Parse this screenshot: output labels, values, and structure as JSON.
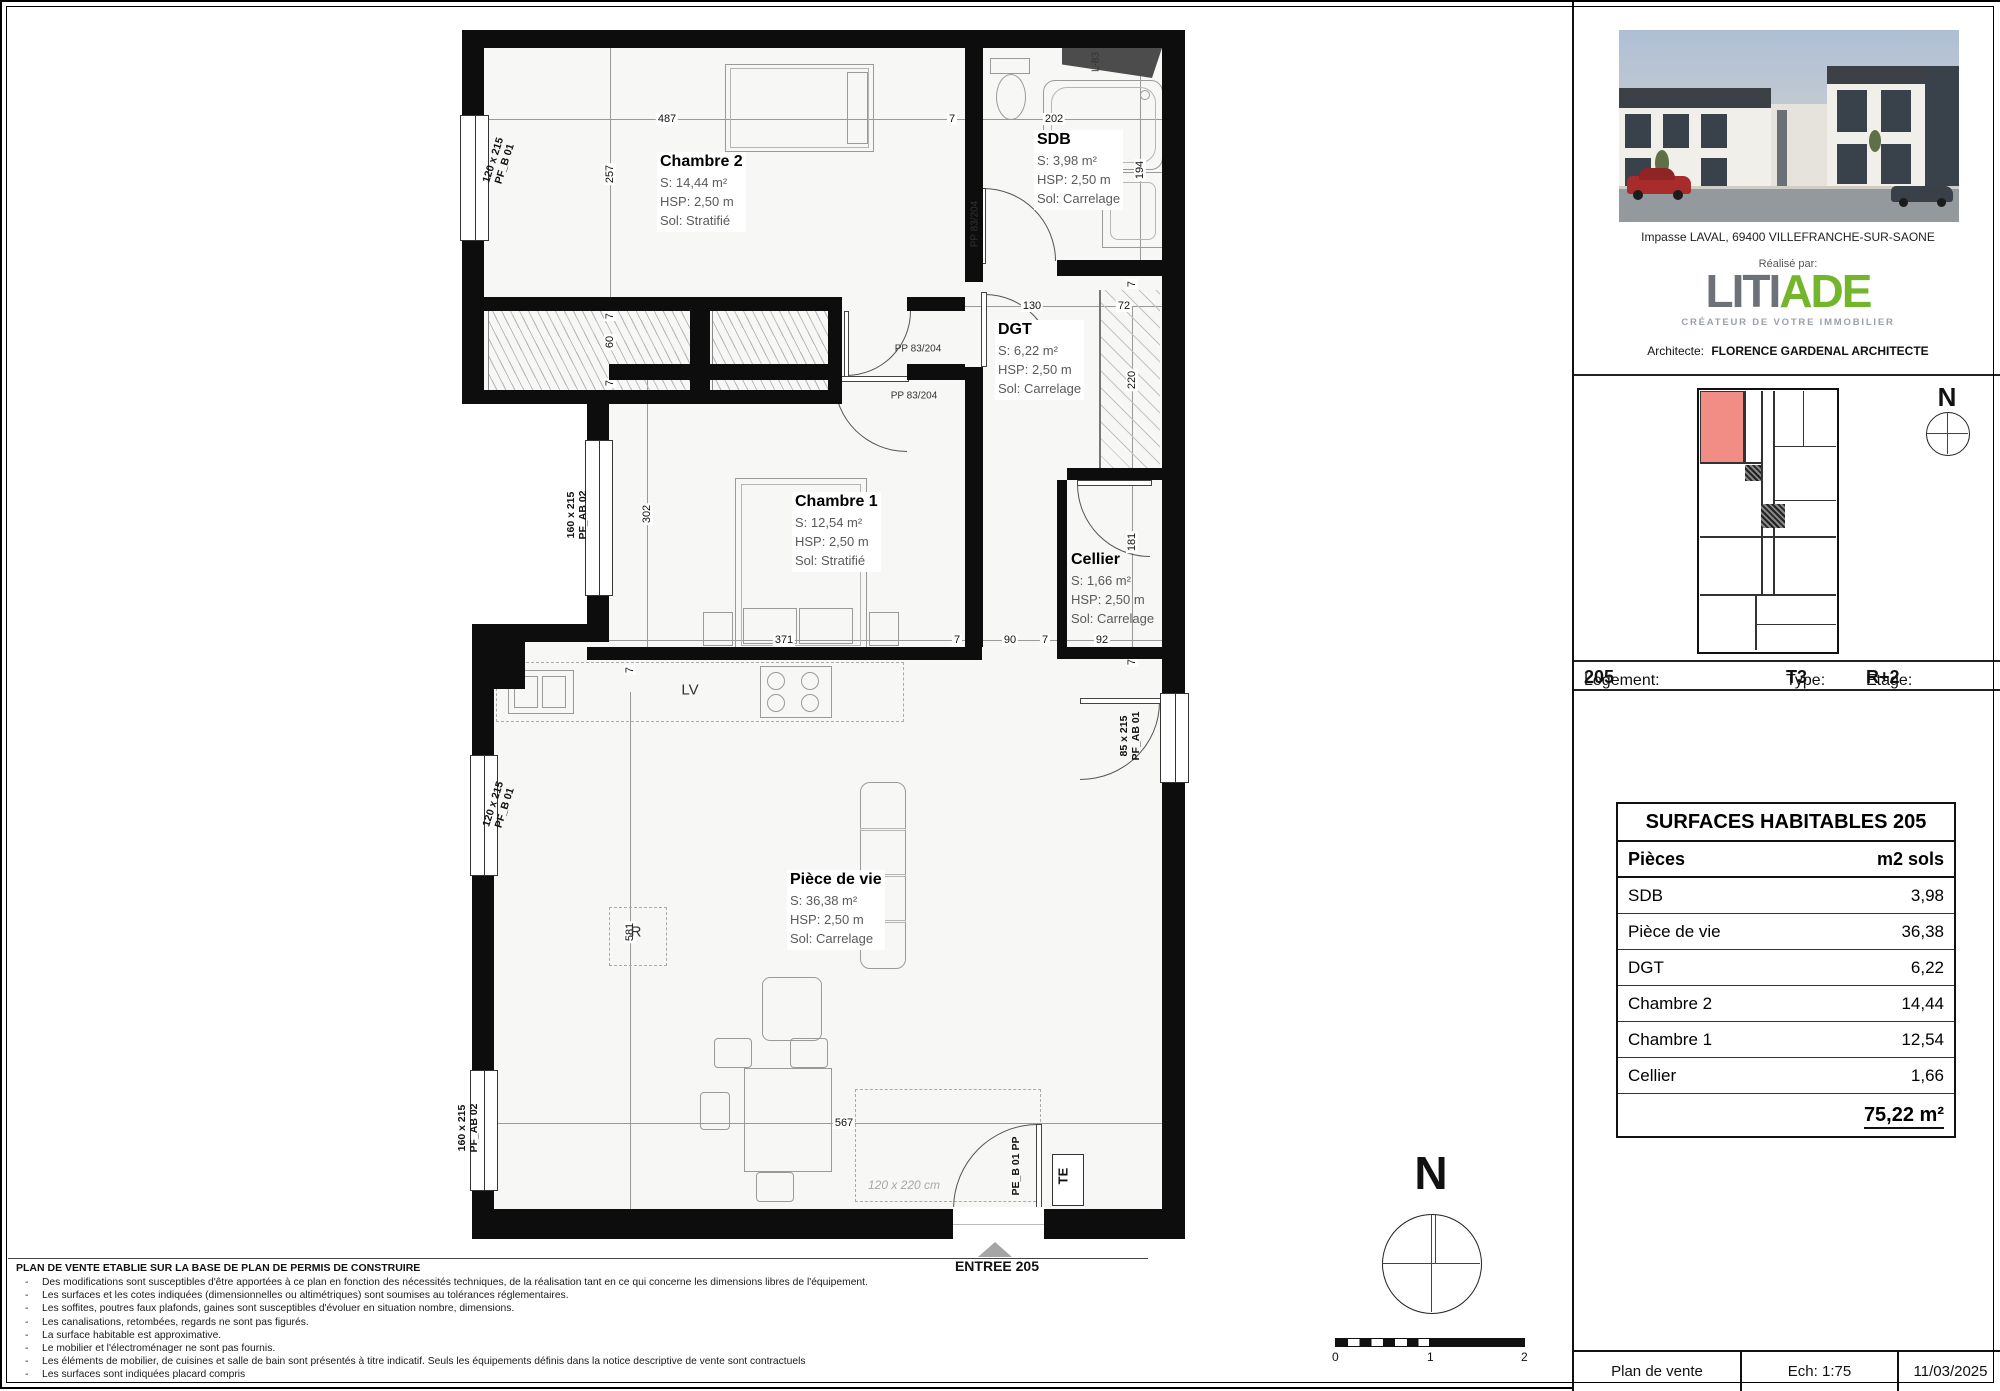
{
  "plan": {
    "rooms": [
      {
        "name": "Chambre 2",
        "surface": "S: 14,44 m²",
        "hsp": "HSP: 2,50 m",
        "sol": "Sol: Stratifié"
      },
      {
        "name": "SDB",
        "surface": "S: 3,98 m²",
        "hsp": "HSP: 2,50 m",
        "sol": "Sol: Carrelage"
      },
      {
        "name": "DGT",
        "surface": "S: 6,22 m²",
        "hsp": "HSP: 2,50 m",
        "sol": "Sol: Carrelage"
      },
      {
        "name": "Chambre 1",
        "surface": "S: 12,54 m²",
        "hsp": "HSP: 2,50 m",
        "sol": "Sol: Stratifié"
      },
      {
        "name": "Cellier",
        "surface": "S: 1,66 m²",
        "hsp": "HSP: 2,50 m",
        "sol": "Sol: Carrelage"
      },
      {
        "name": "Pièce de vie",
        "surface": "S: 36,38 m²",
        "hsp": "HSP: 2,50 m",
        "sol": "Sol: Carrelage"
      }
    ],
    "dims": [
      {
        "t": "487",
        "x": 665,
        "y": 117
      },
      {
        "t": "7",
        "x": 950,
        "y": 117
      },
      {
        "t": "202",
        "x": 1052,
        "y": 117
      },
      {
        "t": "257",
        "x": 608,
        "y": 172,
        "r": 1
      },
      {
        "t": "194",
        "x": 1138,
        "y": 168,
        "r": 1
      },
      {
        "t": "130",
        "x": 1030,
        "y": 304
      },
      {
        "t": "72",
        "x": 1122,
        "y": 304
      },
      {
        "t": "7",
        "x": 1130,
        "y": 282,
        "r": 1
      },
      {
        "t": "220",
        "x": 1130,
        "y": 378,
        "r": 1
      },
      {
        "t": "7",
        "x": 608,
        "y": 314,
        "r": 1
      },
      {
        "t": "60",
        "x": 608,
        "y": 340,
        "r": 1
      },
      {
        "t": "7",
        "x": 608,
        "y": 381,
        "r": 1
      },
      {
        "t": "302",
        "x": 645,
        "y": 512,
        "r": 1
      },
      {
        "t": "371",
        "x": 782,
        "y": 638
      },
      {
        "t": "7",
        "x": 955,
        "y": 638
      },
      {
        "t": "90",
        "x": 1008,
        "y": 638
      },
      {
        "t": "7",
        "x": 1043,
        "y": 638
      },
      {
        "t": "92",
        "x": 1100,
        "y": 638
      },
      {
        "t": "181",
        "x": 1130,
        "y": 540,
        "r": 1
      },
      {
        "t": "7",
        "x": 1130,
        "y": 660,
        "r": 1
      },
      {
        "t": "7",
        "x": 628,
        "y": 668,
        "r": 1
      },
      {
        "t": "581",
        "x": 628,
        "y": 930,
        "r": 1
      },
      {
        "t": "567",
        "x": 842,
        "y": 1121
      }
    ],
    "labels": [
      {
        "t": "120 x 215",
        "s": "PF_B 01",
        "x": 497,
        "y": 160,
        "rot": -72,
        "cls": "win-l"
      },
      {
        "t": "160 x 215",
        "s": "PF_AB 02",
        "x": 575,
        "y": 513,
        "rot": -90,
        "cls": "win-l"
      },
      {
        "t": "120 x 215",
        "s": "PF_B 01",
        "x": 497,
        "y": 804,
        "rot": -72,
        "cls": "win-l"
      },
      {
        "t": "160 x 215",
        "s": "PF_AB 02",
        "x": 466,
        "y": 1126,
        "rot": -90,
        "cls": "win-l"
      },
      {
        "t": "85 x 215",
        "s": "PF_AB 01",
        "x": 1128,
        "y": 734,
        "rot": -90,
        "cls": "win-l"
      },
      {
        "t": "PE_B 01 PP",
        "x": 1014,
        "y": 1164,
        "rot": -90,
        "cls": "win-l"
      },
      {
        "t": "TE",
        "x": 1062,
        "y": 1174,
        "rot": -90,
        "cls": "te-l"
      },
      {
        "t": "PP 83/204",
        "x": 973,
        "y": 222,
        "rot": -90,
        "cls": "door-l"
      },
      {
        "t": "PP 83/204",
        "x": 916,
        "y": 347,
        "rot": 0,
        "cls": "door-l"
      },
      {
        "t": "PP 83/204",
        "x": 912,
        "y": 394,
        "rot": 0,
        "cls": "door-l"
      },
      {
        "t": "L-83",
        "x": 1094,
        "y": 60,
        "rot": -90,
        "cls": "door-l"
      },
      {
        "t": "LV",
        "x": 688,
        "y": 688,
        "rot": 0,
        "cls": "appl-l"
      },
      {
        "t": "R",
        "x": 634,
        "y": 930,
        "rot": 0,
        "cls": "appl-l"
      },
      {
        "t": "120 x 220 cm",
        "x": 902,
        "y": 1184,
        "rot": 0,
        "cls": "resv-l"
      }
    ],
    "entry_label": "ENTREE 205",
    "compass_letter": "N"
  },
  "sidebar": {
    "address": "Impasse LAVAL, 69400 VILLEFRANCHE-SUR-SAONE",
    "realise": "Réalisé par:",
    "logo": {
      "part1": "LITI",
      "part2": "ADE",
      "tagline": "CRÉATEUR DE VOTRE IMMOBILIER"
    },
    "architect_label": "Architecte:",
    "architect_name": "FLORENCE GARDENAL ARCHITECTE",
    "unit": {
      "logement_label": "Logement:",
      "logement": "205",
      "type_label": "Type:",
      "type": "T3",
      "etage_label": "Etage:",
      "etage": "R+2"
    },
    "compass_letter": "N"
  },
  "table": {
    "title": "SURFACES HABITABLES  205",
    "col_left": "Pièces",
    "col_right": "m2 sols",
    "rows": [
      [
        "SDB",
        "3,98"
      ],
      [
        "Pièce de vie",
        "36,38"
      ],
      [
        "DGT",
        "6,22"
      ],
      [
        "Chambre 2",
        "14,44"
      ],
      [
        "Chambre 1",
        "12,54"
      ],
      [
        "Cellier",
        "1,66"
      ]
    ],
    "total": "75,22 m²"
  },
  "footer": [
    "Plan de vente",
    "Ech: 1:75",
    "11/03/2025"
  ],
  "notes": {
    "title": "PLAN DE VENTE ETABLIE SUR LA BASE DE PLAN DE PERMIS DE CONSTRUIRE",
    "items": [
      "Des modifications sont susceptibles d'être apportées à ce plan en fonction des nécessités techniques, de la réalisation tant en ce qui concerne les dimensions libres de l'équipement.",
      "Les surfaces et les cotes indiquées (dimensionnelles ou altimétriques) sont soumises au tolérances réglementaires.",
      "Les soffites, poutres faux plafonds, gaines sont susceptibles d'évoluer en situation nombre, dimensions.",
      "Les canalisations, retombées, regards ne sont pas figurés.",
      "La surface habitable est approximative.",
      "Le mobilier et l'électroménager ne sont pas fournis.",
      "Les éléments de mobilier, de cuisines et salle de bain sont présentés à titre indicatif. Seuls les équipements définis dans la notice descriptive de vente sont contractuels",
      "Les surfaces sont indiquées placard compris"
    ]
  },
  "scalebar": {
    "labels": [
      "0",
      "1",
      "2"
    ]
  },
  "colors": {
    "wall": "#0d0d0d",
    "highlight_unit": "#f28d85",
    "logo_gray": "#6d7278",
    "logo_green": "#73b62c"
  }
}
